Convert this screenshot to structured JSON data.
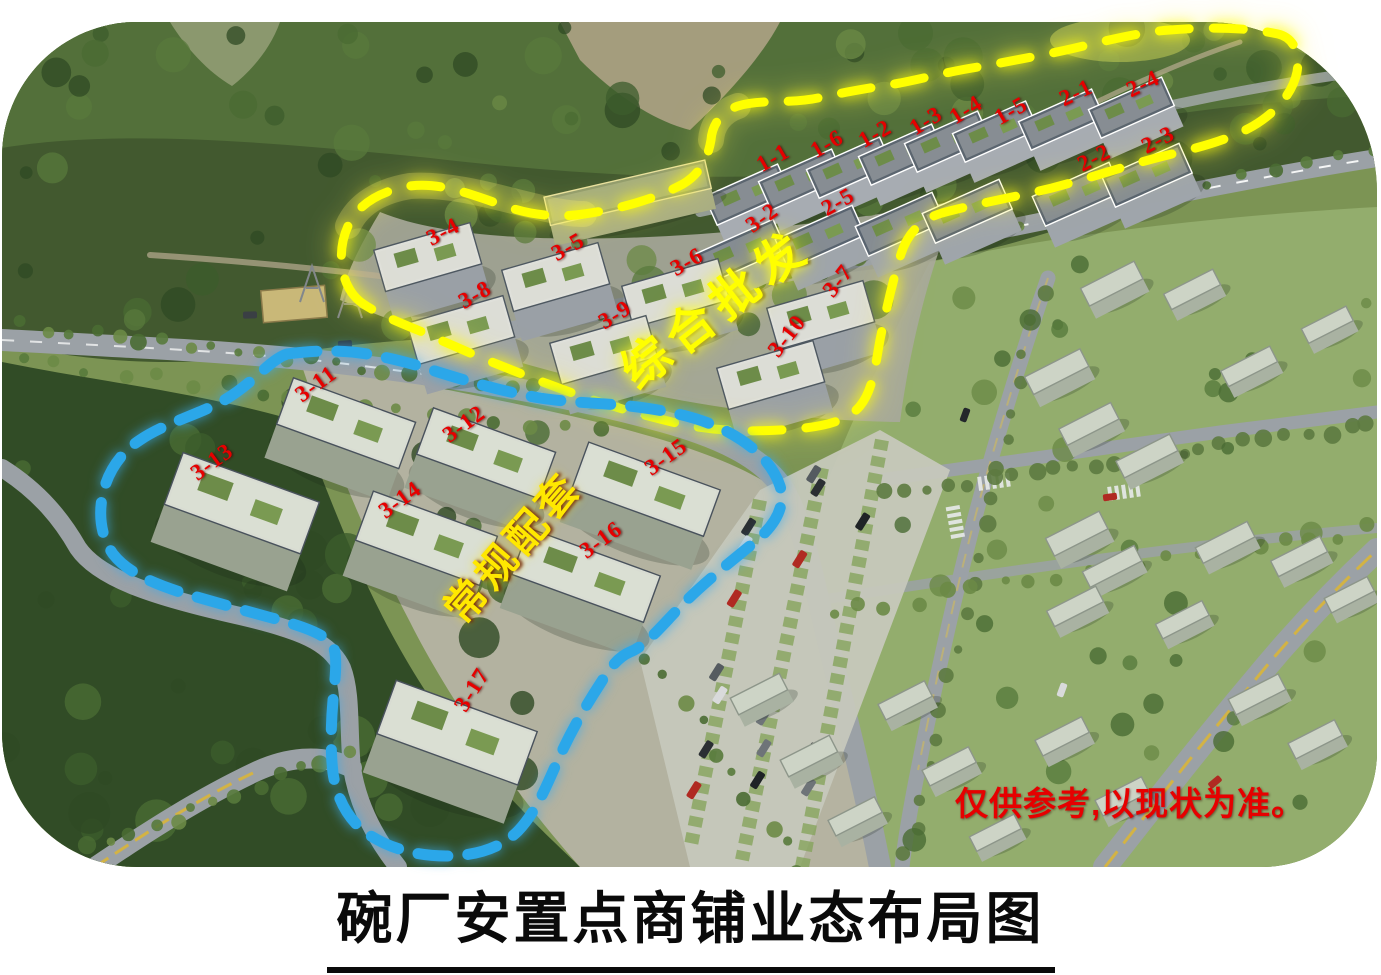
{
  "page": {
    "background": "#ffffff"
  },
  "title": {
    "text": "碗厂安置点商铺业态布局图"
  },
  "disclaimer": {
    "text": "仅供参考,以现状为准。",
    "color": "#e60000",
    "x": 955,
    "y": 797
  },
  "label_style": {
    "color": "#e60000"
  },
  "zones": [
    {
      "id": "wholesale",
      "name": "综合批发",
      "boundary_color": "#ffff00",
      "label_color": "#ffff00",
      "label_x": 713,
      "label_y": 305,
      "label_rotation_deg": -38
    },
    {
      "id": "regular",
      "name": "常规配套",
      "boundary_color": "#2ba7e9",
      "label_color": "#ffe800",
      "label_x": 510,
      "label_y": 545,
      "label_rotation_deg": -49
    }
  ],
  "building_labels": [
    {
      "id": "1-1",
      "x": 773,
      "y": 158,
      "rot": -30
    },
    {
      "id": "1-6",
      "x": 827,
      "y": 144,
      "rot": -30
    },
    {
      "id": "1-2",
      "x": 875,
      "y": 134,
      "rot": -30
    },
    {
      "id": "1-3",
      "x": 926,
      "y": 121,
      "rot": -32
    },
    {
      "id": "1-4",
      "x": 966,
      "y": 110,
      "rot": -32
    },
    {
      "id": "1-5",
      "x": 1011,
      "y": 111,
      "rot": -30
    },
    {
      "id": "2-1",
      "x": 1076,
      "y": 93,
      "rot": -26
    },
    {
      "id": "2-4",
      "x": 1143,
      "y": 84,
      "rot": -26
    },
    {
      "id": "2-2",
      "x": 1094,
      "y": 158,
      "rot": -28
    },
    {
      "id": "2-3",
      "x": 1158,
      "y": 140,
      "rot": -28
    },
    {
      "id": "3-2",
      "x": 762,
      "y": 218,
      "rot": -36
    },
    {
      "id": "2-5",
      "x": 838,
      "y": 202,
      "rot": -30
    },
    {
      "id": "3-4",
      "x": 443,
      "y": 232,
      "rot": -28
    },
    {
      "id": "3-5",
      "x": 568,
      "y": 247,
      "rot": -30
    },
    {
      "id": "3-6",
      "x": 687,
      "y": 262,
      "rot": -30
    },
    {
      "id": "3-7",
      "x": 838,
      "y": 281,
      "rot": -52
    },
    {
      "id": "3-8",
      "x": 475,
      "y": 295,
      "rot": -30
    },
    {
      "id": "3-9",
      "x": 615,
      "y": 315,
      "rot": -32
    },
    {
      "id": "3-10",
      "x": 787,
      "y": 336,
      "rot": -52
    },
    {
      "id": "3-11",
      "x": 316,
      "y": 384,
      "rot": -36
    },
    {
      "id": "3-12",
      "x": 464,
      "y": 424,
      "rot": -36
    },
    {
      "id": "3-13",
      "x": 212,
      "y": 462,
      "rot": -36
    },
    {
      "id": "3-14",
      "x": 400,
      "y": 500,
      "rot": -36
    },
    {
      "id": "3-15",
      "x": 666,
      "y": 457,
      "rot": -36
    },
    {
      "id": "3-16",
      "x": 601,
      "y": 540,
      "rot": -36
    },
    {
      "id": "3-17",
      "x": 472,
      "y": 690,
      "rot": -58
    }
  ]
}
